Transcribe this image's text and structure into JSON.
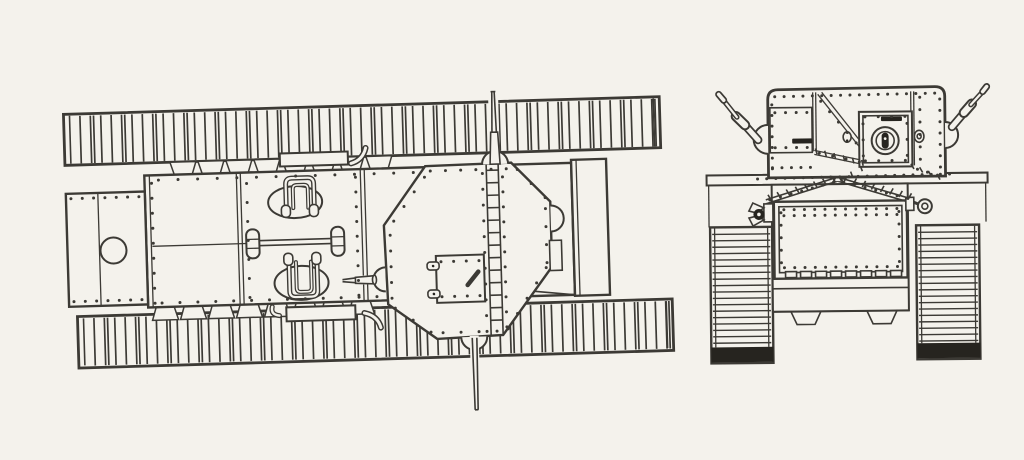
{
  "page": {
    "colors": {
      "paper": "#f4f2ec",
      "ink": "#3c3a35",
      "dark": "#26241f"
    }
  },
  "figure": {
    "alt": "Two-view technical line drawing of a WWI-era tank: top plan view on the left, front elevation on the right",
    "views": [
      {
        "id": "plan-view",
        "name": "tank-top-plan-view"
      },
      {
        "id": "front-view",
        "name": "tank-front-elevation-view"
      }
    ],
    "slat_tracks": [
      {
        "into": "g-ttrack",
        "x0": 73,
        "xend": 659,
        "y1": 107.5,
        "y2": 155,
        "step": 10.4
      },
      {
        "into": "g-btrack",
        "x0": 81,
        "xend": 666,
        "y1": 310,
        "y2": 357.5,
        "step": 10.4
      }
    ],
    "link_tracks": [
      {
        "into": "g-ltrack",
        "x1": 712,
        "x2": 770,
        "y0": 233,
        "yend": 344,
        "step": 6.4
      },
      {
        "into": "g-rtrack",
        "x1": 918,
        "x2": 977,
        "y0": 233,
        "yend": 342,
        "step": 6.4
      }
    ],
    "tabs": [
      {
        "into": "g-tabs-t",
        "x0": 172,
        "step": 28,
        "count": 8,
        "w": 26,
        "ya": 156.5,
        "yb": 169
      },
      {
        "into": "g-tabs-b",
        "x0": 150,
        "step": 28,
        "count": 8,
        "w": 26,
        "ya": 314,
        "yb": 301
      }
    ],
    "rules": [
      {
        "into": "g-plan-lad",
        "x1": 488,
        "x2": 500,
        "y0": 174,
        "y1": 336,
        "step": 12.5
      }
    ],
    "rivet_sets": [
      {
        "into": "g-plan-riv",
        "rows": [
          [
            72,
            190,
            140,
            190,
            7
          ],
          [
            72,
            293,
            140,
            293,
            7
          ],
          [
            153,
            177,
            153,
            297,
            9
          ],
          [
            160,
            174,
            415,
            174,
            14
          ],
          [
            160,
            297,
            375,
            297,
            13
          ],
          [
            248,
            180,
            248,
            294,
            7
          ],
          [
            357,
            177,
            357,
            295,
            9
          ],
          [
            432,
            173,
            508,
            173,
            6
          ],
          [
            394,
            222,
            426,
            179,
            4
          ],
          [
            390,
            236,
            390,
            299,
            5
          ],
          [
            393,
            309,
            428,
            334,
            3
          ],
          [
            440,
            335,
            494,
            335,
            4
          ],
          [
            505,
            333,
            545,
            273,
            5
          ],
          [
            546,
            214,
            546,
            268,
            4
          ],
          [
            519,
            174,
            546,
            203,
            3
          ],
          [
            484,
            177,
            484,
            335,
            11
          ],
          [
            504,
            181,
            504,
            331,
            11
          ],
          [
            440,
            264,
            478,
            264,
            4
          ],
          [
            440,
            299,
            478,
            299,
            4
          ]
        ]
      },
      {
        "into": "g-front-riv",
        "rows": [
          [
            776,
            96,
            936,
            94,
            18
          ],
          [
            773,
            104,
            773,
            168,
            7
          ],
          [
            941,
            100,
            941,
            168,
            7
          ],
          [
            776,
            112,
            808,
            112,
            4
          ],
          [
            776,
            147,
            808,
            147,
            4
          ],
          [
            822,
            101,
            857,
            143,
            5
          ],
          [
            866,
            117,
            906,
            117,
            4
          ],
          [
            866,
            161,
            906,
            161,
            4
          ],
          [
            864,
            124,
            864,
            156,
            3
          ],
          [
            908,
            124,
            908,
            156,
            3
          ],
          [
            921,
            98,
            921,
            160,
            6
          ],
          [
            758,
            178,
            950,
            175,
            22
          ],
          [
            770,
            199,
            834,
            182,
            7
          ],
          [
            844,
            182,
            908,
            199,
            7
          ],
          [
            784,
            209,
            897,
            209,
            12
          ],
          [
            784,
            215,
            897,
            215,
            12
          ],
          [
            784,
            267,
            897,
            267,
            12
          ],
          [
            781,
            212,
            781,
            262,
            5
          ],
          [
            899,
            212,
            899,
            262,
            5
          ],
          [
            820,
            153,
            860,
            162,
            4
          ],
          [
            773,
            167,
            811,
            167,
            5
          ],
          [
            918,
            170,
            938,
            176,
            3
          ]
        ]
      }
    ],
    "tick_sets": [
      {
        "into": "g-front-tick",
        "rows": [
          [
            770,
            197,
            834,
            179,
            8,
            7,
            60
          ],
          [
            846,
            179,
            910,
            197,
            8,
            7,
            120
          ],
          [
            817,
            151,
            863,
            163,
            6,
            6,
            75
          ],
          [
            913,
            167,
            939,
            178,
            4,
            6,
            60
          ],
          [
            842,
            179,
            862,
            169,
            3,
            5,
            70
          ]
        ]
      }
    ]
  }
}
